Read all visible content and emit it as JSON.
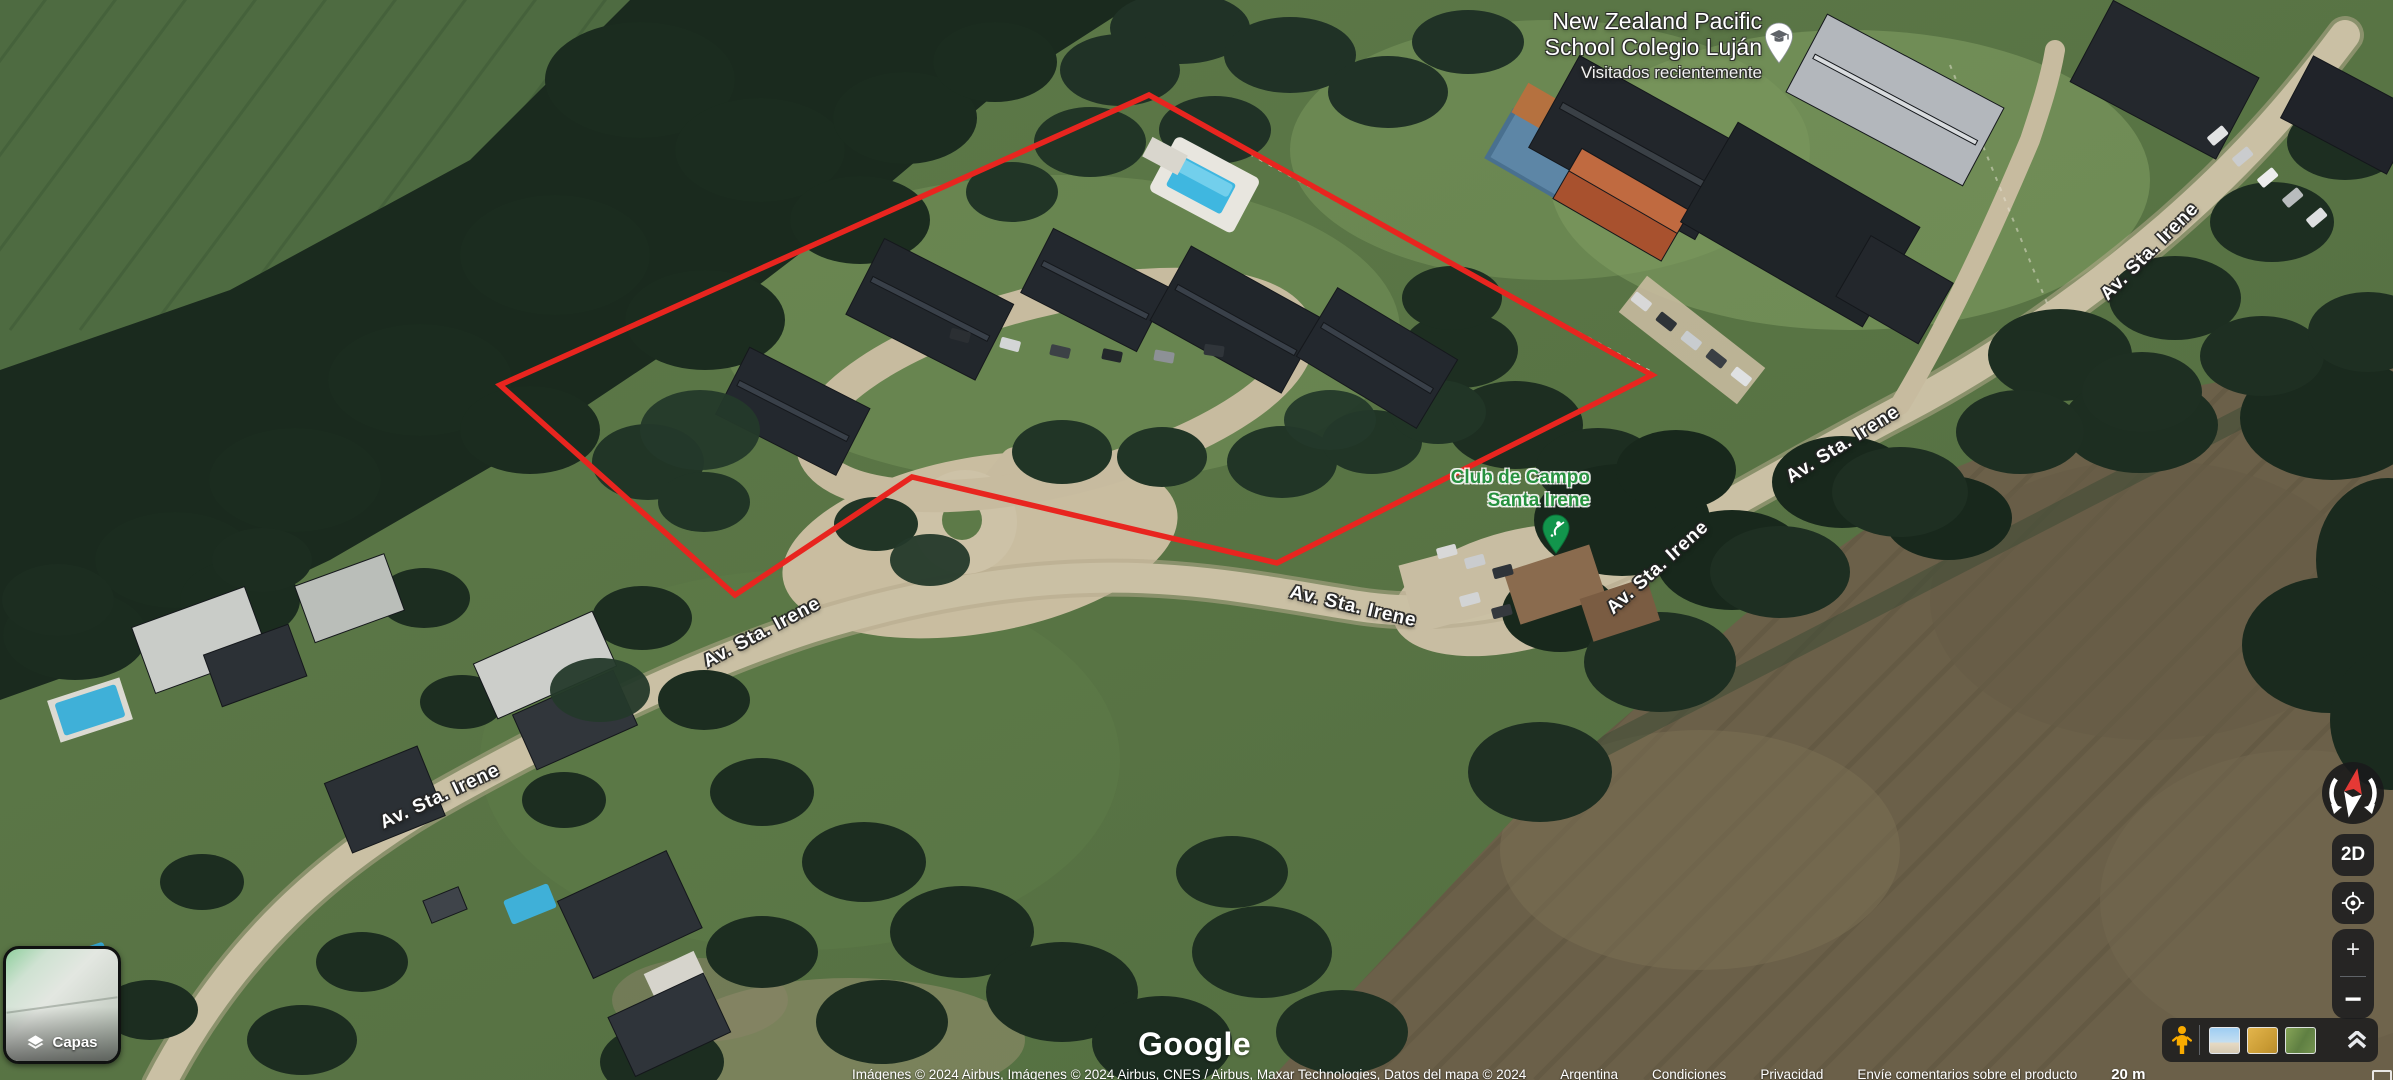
{
  "poi": {
    "school": {
      "line1": "New Zealand Pacific",
      "line2": "School Colegio Luján",
      "visited": "Visitados recientemente"
    },
    "club": {
      "line1": "Club de Campo",
      "line2": "Santa Irene"
    }
  },
  "streets": {
    "name": "Av. Sta. Irene"
  },
  "controls": {
    "layers": "Capas",
    "two_d": "2D",
    "zoom_in": "+",
    "zoom_out": "−"
  },
  "logo": {
    "text": "Google"
  },
  "footer": {
    "attribution": "Imágenes © 2024 Airbus, Imágenes © 2024 Airbus, CNES / Airbus, Maxar Technologies, Datos del mapa © 2024",
    "links": {
      "region": "Argentina",
      "terms": "Condiciones",
      "privacy": "Privacidad",
      "feedback": "Envíe comentarios sobre el producto"
    },
    "scale": "20 m"
  },
  "colors": {
    "boundary_red": "#e8251f",
    "poi_green": "#27913f",
    "pegman_yellow": "#f9ab00"
  }
}
